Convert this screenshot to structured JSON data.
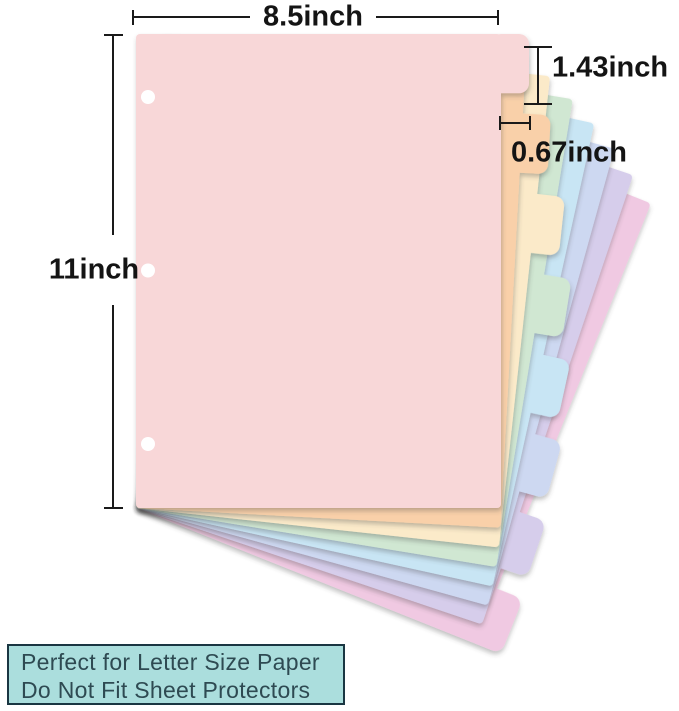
{
  "diagram": {
    "dimensions": {
      "width": {
        "label": "8.5inch"
      },
      "height": {
        "label": "11inch"
      },
      "tab_height": {
        "label": "1.43inch"
      },
      "tab_width": {
        "label": "0.67inch"
      }
    },
    "line_color": "#1a1a1a",
    "hole_count": 3,
    "sheets": [
      {
        "name": "pink",
        "color": "#f8d7d8",
        "angle": 0
      },
      {
        "name": "peach",
        "color": "#f9d0a9",
        "angle": 3.1
      },
      {
        "name": "cream",
        "color": "#fbeac9",
        "angle": 6.2
      },
      {
        "name": "mint",
        "color": "#d0e7d2",
        "angle": 9.3
      },
      {
        "name": "blue",
        "color": "#c8e5f4",
        "angle": 12.4
      },
      {
        "name": "periwinkle",
        "color": "#cdd8f1",
        "angle": 15.5
      },
      {
        "name": "lavender",
        "color": "#d6cdeb",
        "angle": 18.6
      },
      {
        "name": "magenta",
        "color": "#f0c9e2",
        "angle": 21.8
      }
    ]
  },
  "info_box": {
    "line1": "Perfect for Letter Size Paper",
    "line2": "Do Not Fit Sheet Protectors",
    "background": "#abdedd",
    "border_color": "#1a3642",
    "text_color": "#2e4a52"
  }
}
